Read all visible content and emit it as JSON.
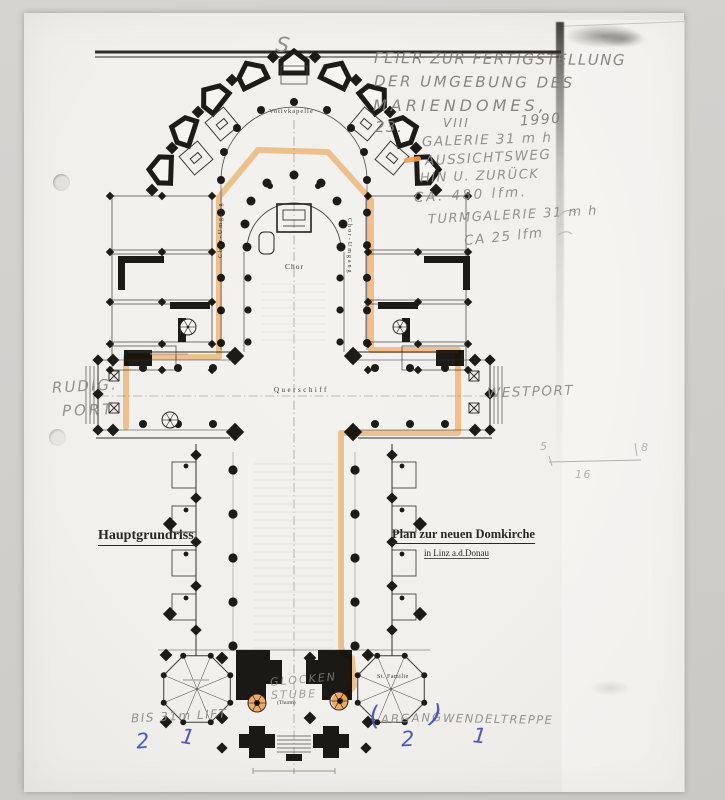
{
  "annotations": {
    "pencil": {
      "title1": "FEIER ZUR FERTIGSTELLUNG",
      "title2": "DER UMGEBUNG DES",
      "title3": "MARIENDOMES,",
      "date_day": "23.",
      "date_month": "VIII",
      "date_year": "1990",
      "gallery": "GALERIE 31 m h",
      "route": "AUSSICHTSWEG",
      "route2": "HIN U. ZURÜCK",
      "route3": "CA. 480 lfm.",
      "tower_gallery": "TURMGALERIE 31 m h",
      "tower_gallery2": "CA 25 lfm",
      "compass": "S",
      "rudig1": "RUDIG.",
      "rudig2": "PORT",
      "westport": "WESTPORT",
      "glocken1": "GLOCKEN",
      "glocken2": "STUBE",
      "lift": "BIS 31m LIFT",
      "abgang": "ABGANG",
      "wendeltreppe": "WENDELTREPPE",
      "sketch_5": "5",
      "sketch_8": "8",
      "sketch_16": "16"
    },
    "blue": {
      "paren_open": "(",
      "paren_close": ")",
      "num_lift_2": "2",
      "num_lift_1": "1",
      "num_abgang_2": "2",
      "num_wendel_1": "1"
    }
  },
  "plan": {
    "caption_left": "Hauptgrundriss.",
    "caption_right": "Plan zur neuen Domkirche",
    "caption_right_sub": "in Linz a.d.Donau",
    "label_votive": "Votivkapelle",
    "label_choir": "Chor",
    "label_ambulatory": "Chor-Umgang",
    "label_transept": "Querschiff",
    "label_family": "St. Familie",
    "label_tower": "(Thurm)"
  },
  "colors": {
    "highlighter": "#f6a045",
    "pencil": "#8d8a85",
    "blue_ink": "#4553b8",
    "print_ink": "#26231f",
    "paper": "#f2f0ec"
  }
}
